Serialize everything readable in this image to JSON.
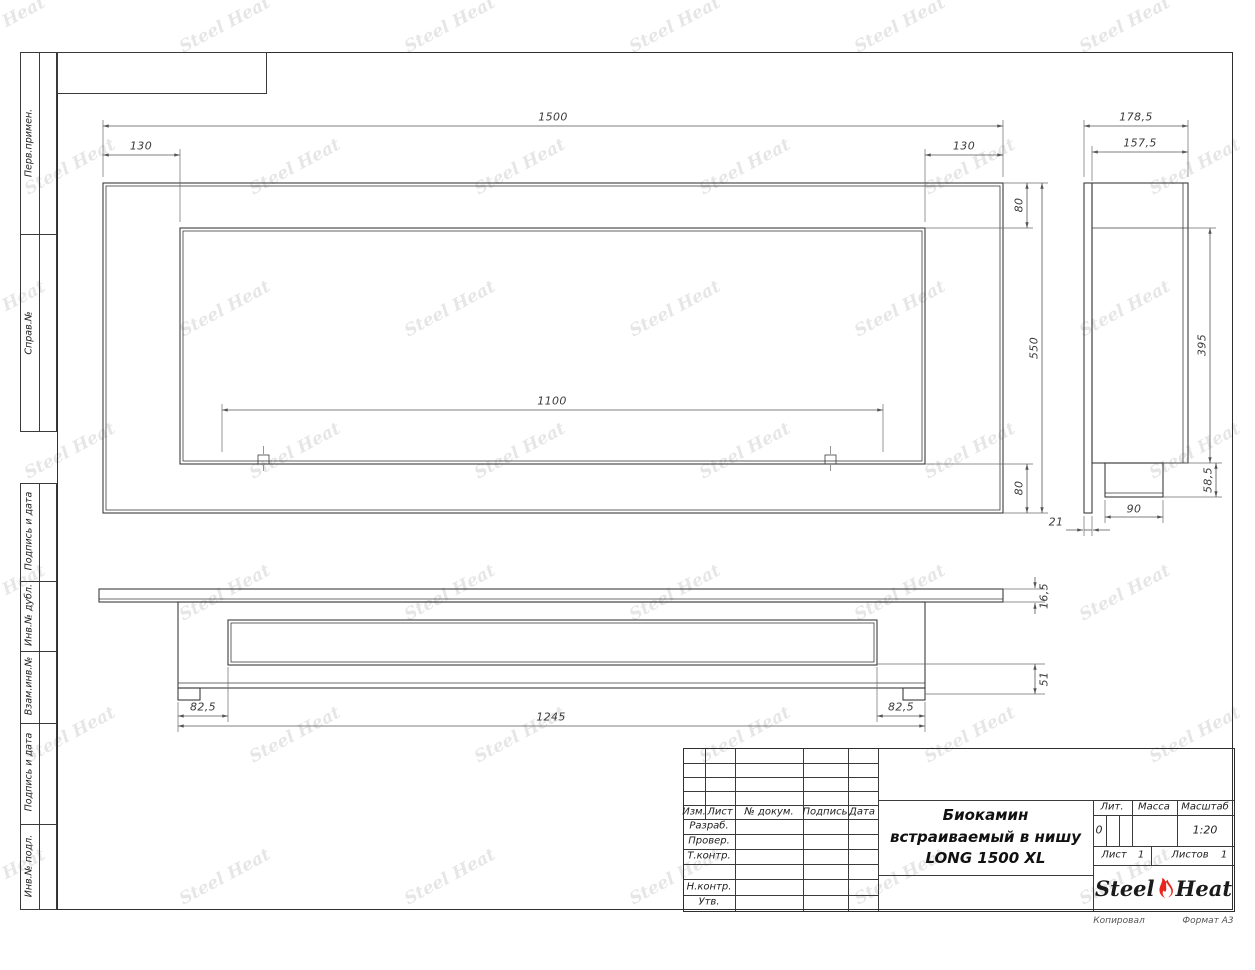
{
  "sheet": {
    "watermark_text": "Steel Heat",
    "footer": {
      "copied": "Копировал",
      "format": "Формат A3"
    }
  },
  "sidebar": {
    "cells": [
      {
        "label": "Перв.примен."
      },
      {
        "label": "Справ.№"
      },
      {
        "label": "Подпись и дата"
      },
      {
        "label": "Инв.№ дубл."
      },
      {
        "label": "Взам.инв.№"
      },
      {
        "label": "Подпись и дата"
      },
      {
        "label": "Инв.№ подл."
      }
    ]
  },
  "title_block": {
    "header_cols": {
      "izm": "Изм.",
      "list": "Лист",
      "doc": "№ докум.",
      "sign": "Подпись",
      "date": "Дата"
    },
    "rows": {
      "dev": "Разраб.",
      "check": "Провер.",
      "tcontrol": "Т.контр.",
      "ncontrol": "Н.контр.",
      "approve": "Утв."
    },
    "title_line1": "Биокамин",
    "title_line2": "встраиваемый в нишу",
    "title_line3": "LONG 1500 XL",
    "lit_label": "Лит.",
    "lit_value": "0",
    "mass_label": "Масса",
    "scale_label": "Масштаб",
    "scale_value": "1:20",
    "sheet_label": "Лист",
    "sheet_value": "1",
    "sheets_label": "Листов",
    "sheets_value": "1",
    "brand_left": "Steel",
    "brand_right": "Heat"
  },
  "dims": {
    "front": {
      "overall_width": "1500",
      "left_offset": "130",
      "right_offset": "130",
      "top_margin": "80",
      "panel_height": "550",
      "bottom_margin": "80",
      "mount_span": "1100"
    },
    "side": {
      "overall_depth": "178,5",
      "body_depth": "157,5",
      "inner_height": "395",
      "box_height": "58,5",
      "box_width": "90",
      "flange_offset": "21"
    },
    "bottom": {
      "flange_thickness": "16,5",
      "body_depth": "51",
      "left_inset": "82,5",
      "body_width": "1245",
      "right_inset": "82,5"
    }
  }
}
